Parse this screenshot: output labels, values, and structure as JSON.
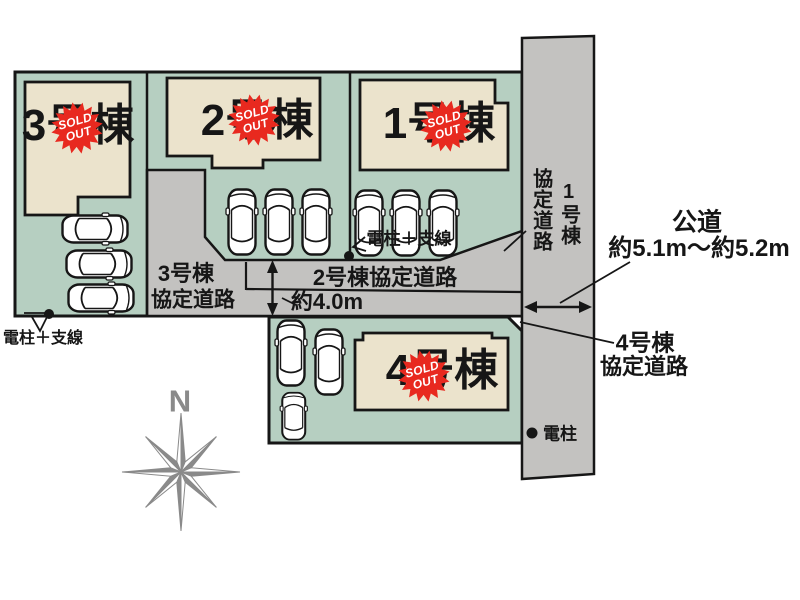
{
  "plots": [
    {
      "id": "1",
      "label": "1号棟",
      "status": "sold_out"
    },
    {
      "id": "2",
      "label": "2号棟",
      "status": "sold_out"
    },
    {
      "id": "3",
      "label": "3号棟",
      "status": "sold_out"
    },
    {
      "id": "4",
      "label": "4号棟",
      "status": "sold_out"
    }
  ],
  "badge": {
    "line1": "SOLD",
    "line2": "OUT"
  },
  "roads": {
    "road1": {
      "line1": "1号棟",
      "line2": "協定道路",
      "orientation": "vertical"
    },
    "road2": {
      "label": "2号棟協定道路",
      "width_note": "約4.0m"
    },
    "road3": {
      "line1": "3号棟",
      "line2": "協定道路"
    },
    "road4": {
      "line1": "4号棟",
      "line2": "協定道路"
    },
    "public_road": {
      "name": "公道",
      "width_note": "約5.1m〜約5.2m"
    }
  },
  "annotations": {
    "pole_guy_left": "電柱＋支線",
    "pole_guy_center": "電柱＋支線",
    "pole_on_road": "電柱"
  },
  "compass": {
    "north": "N"
  },
  "counts": {
    "cars_total": 12
  },
  "colors": {
    "plot_green": "#b6cfc1",
    "building_beige": "#ebe3cc",
    "road_gray": "#c3c2c0",
    "badge_red": "#e8291f",
    "outline_black": "#161616",
    "compass_gray": "#8a8a8a"
  }
}
